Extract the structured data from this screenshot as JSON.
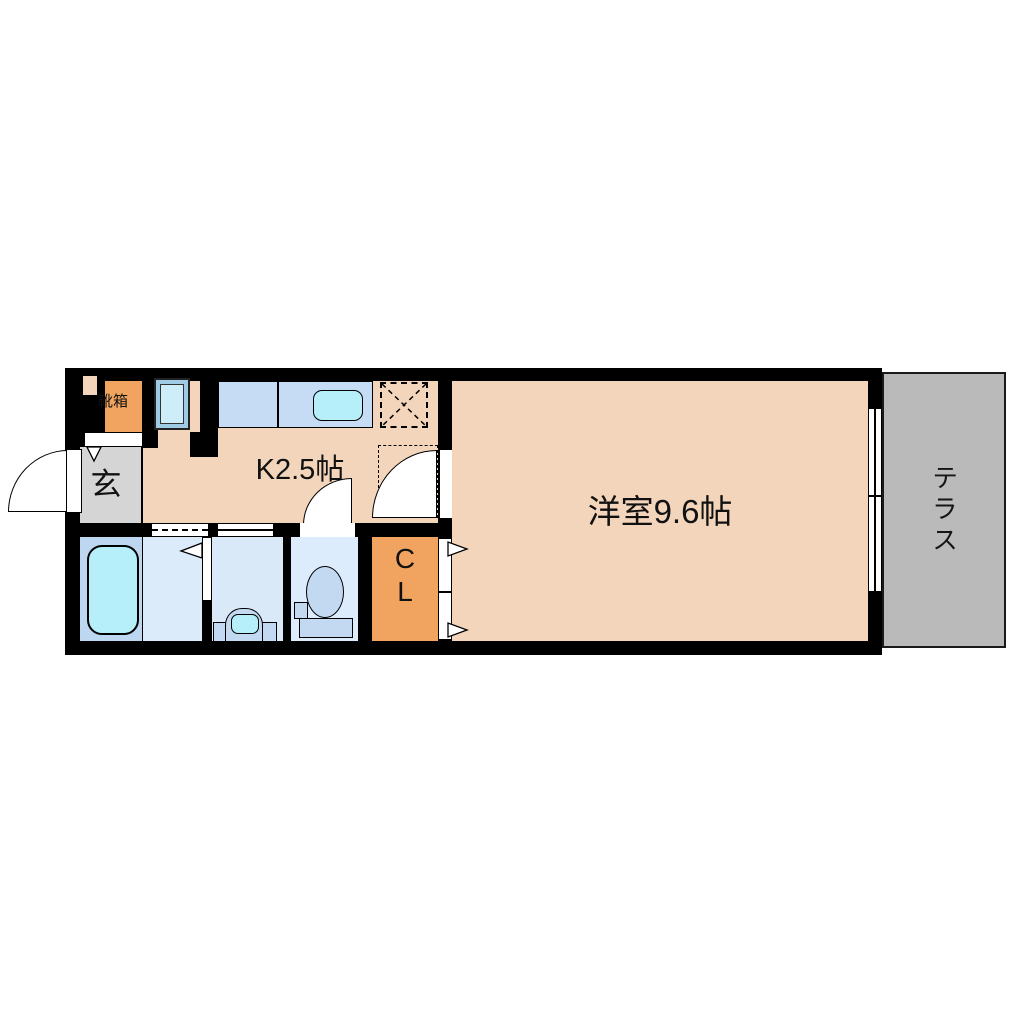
{
  "title": "1K apartment floor plan",
  "unit": {
    "entrance": {
      "label": "玄"
    },
    "shoe_box": {
      "label": "靴箱"
    },
    "kitchen": {
      "label": "K2.5帖"
    },
    "main_room": {
      "label": "洋室9.6帖"
    },
    "closet": {
      "label_line1": "C",
      "label_line2": "L"
    },
    "terrace": {
      "label": "テラス"
    }
  },
  "fixtures": {
    "bathtub": "bathtub",
    "toilet": "toilet",
    "washbasin": "washbasin",
    "kitchen_sink": "kitchen-sink",
    "refrigerator_space": "refrigerator-space",
    "washing_machine_space": "washing-machine-space",
    "entrance_door": "swing-door",
    "kitchen_room_door": "swing-door",
    "toilet_door": "swing-door",
    "bathroom_door": "folding-door",
    "closet_door": "folding-door",
    "terrace_window": "sliding-window"
  },
  "colors": {
    "page_bg": "#ffffff",
    "wall": "#000000",
    "floor": "#f2d5ba",
    "accent_orange": "#f0a45f",
    "entrance_gray": "#d5d5d5",
    "terrace_gray": "#bababa",
    "bath_floor": "#bdd7f0",
    "wet_room_floor": "#dcebfa",
    "washroom_floor": "#d9e9f8",
    "toilet_floor": "#ddecfc",
    "water_cyan": "#b6eefa",
    "counter_blue": "#c6dbf4",
    "fridge_blue": "#9fcbe4",
    "fridge_inner": "#cdeef8",
    "porcelain_blue": "#c3d9f2"
  }
}
